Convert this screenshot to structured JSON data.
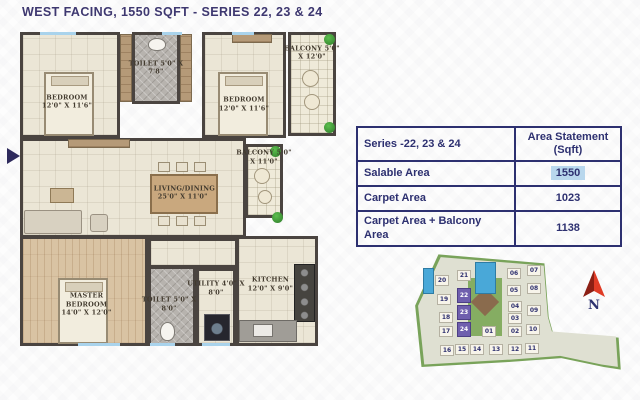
{
  "title": "WEST FACING, 1550 SQFT - SERIES 22, 23 & 24",
  "colors": {
    "accent_navy": "#2d3070",
    "title_navy": "#3e3870",
    "value_highlight_blue": "#b8d7ed",
    "site_block_highlight_purple": "#6f5fae",
    "compass_red": "#e03c26",
    "wall_dark": "#4a4440"
  },
  "floor_plan": {
    "rooms": [
      {
        "id": "bedroom-1",
        "name": "BEDROOM",
        "dims": "12'0\" X 11'6\"",
        "floor": "cream",
        "x": 0,
        "y": 0,
        "w": 100,
        "h": 106,
        "lx": 47,
        "ly": 66
      },
      {
        "id": "toilet-1",
        "name": "TOILET",
        "dims": "5'0\" X 7'8\"",
        "floor": "tile",
        "x": 112,
        "y": 0,
        "w": 48,
        "h": 72,
        "lx": 50,
        "ly": 50
      },
      {
        "id": "bedroom-2",
        "name": "BEDROOM",
        "dims": "12'0\" X 11'6\"",
        "floor": "cream",
        "x": 182,
        "y": 0,
        "w": 84,
        "h": 106,
        "lx": 50,
        "ly": 68
      },
      {
        "id": "balcony-1",
        "name": "BALCONY",
        "dims": "5'0\" X 12'0\"",
        "floor": "grid",
        "x": 268,
        "y": 0,
        "w": 48,
        "h": 104,
        "lx": 50,
        "ly": 20
      },
      {
        "id": "living-dining",
        "name": "LIVING/DINING",
        "dims": "25'0\" X 11'0\"",
        "floor": "cream",
        "x": 0,
        "y": 106,
        "w": 226,
        "h": 100,
        "lx": 72,
        "ly": 55
      },
      {
        "id": "balcony-2",
        "name": "BALCONY",
        "dims": "5'0\" X 11'0\"",
        "floor": "grid",
        "x": 225,
        "y": 112,
        "w": 38,
        "h": 74,
        "lx": 50,
        "ly": 18
      },
      {
        "id": "hallway",
        "name": "",
        "dims": "",
        "floor": "cream",
        "x": 128,
        "y": 206,
        "w": 90,
        "h": 30,
        "lx": 50,
        "ly": 50
      },
      {
        "id": "master-bedroom",
        "name": "MASTER BEDROOM",
        "dims": "14'0\" X 12'0\"",
        "floor": "wood",
        "x": 0,
        "y": 204,
        "w": 128,
        "h": 110,
        "lx": 52,
        "ly": 62
      },
      {
        "id": "toilet-2",
        "name": "TOILET",
        "dims": "5'0\" X 8'0\"",
        "floor": "tile",
        "x": 128,
        "y": 234,
        "w": 48,
        "h": 80,
        "lx": 44,
        "ly": 48
      },
      {
        "id": "utility",
        "name": "UTILITY",
        "dims": "4'0\" X 8'0\"",
        "floor": "cream",
        "x": 176,
        "y": 236,
        "w": 40,
        "h": 78,
        "lx": 50,
        "ly": 26
      },
      {
        "id": "kitchen",
        "name": "KITCHEN",
        "dims": "12'0\" X 9'0\"",
        "floor": "cream",
        "x": 216,
        "y": 204,
        "w": 82,
        "h": 110,
        "lx": 42,
        "ly": 44
      }
    ],
    "furniture": [
      {
        "type": "bed",
        "x": 24,
        "y": 40,
        "w": 50,
        "h": 64
      },
      {
        "type": "bed",
        "x": 198,
        "y": 40,
        "w": 50,
        "h": 64
      },
      {
        "type": "bed-master",
        "x": 38,
        "y": 246,
        "w": 50,
        "h": 66
      },
      {
        "type": "wardrobe",
        "x": 100,
        "y": 2,
        "w": 12,
        "h": 68
      },
      {
        "type": "wardrobe",
        "x": 160,
        "y": 2,
        "w": 12,
        "h": 68
      },
      {
        "type": "wardrobe",
        "x": 212,
        "y": 2,
        "w": 40,
        "h": 9
      },
      {
        "type": "wardrobe",
        "x": 48,
        "y": 107,
        "w": 62,
        "h": 9
      },
      {
        "type": "dining-table",
        "x": 130,
        "y": 142,
        "w": 68,
        "h": 40
      },
      {
        "type": "chair",
        "x": 138,
        "y": 130,
        "w": 12,
        "h": 10
      },
      {
        "type": "chair",
        "x": 156,
        "y": 130,
        "w": 12,
        "h": 10
      },
      {
        "type": "chair",
        "x": 174,
        "y": 130,
        "w": 12,
        "h": 10
      },
      {
        "type": "chair",
        "x": 138,
        "y": 184,
        "w": 12,
        "h": 10
      },
      {
        "type": "chair",
        "x": 156,
        "y": 184,
        "w": 12,
        "h": 10
      },
      {
        "type": "chair",
        "x": 174,
        "y": 184,
        "w": 12,
        "h": 10
      },
      {
        "type": "sofa",
        "x": 4,
        "y": 178,
        "w": 58,
        "h": 24
      },
      {
        "type": "armchair",
        "x": 70,
        "y": 182,
        "w": 18,
        "h": 18
      },
      {
        "type": "coffee-table",
        "x": 30,
        "y": 156,
        "w": 24,
        "h": 15
      },
      {
        "type": "wc",
        "x": 128,
        "y": 6,
        "w": 18,
        "h": 13
      },
      {
        "type": "wc",
        "x": 140,
        "y": 290,
        "w": 15,
        "h": 19
      },
      {
        "type": "washer",
        "x": 184,
        "y": 282,
        "w": 26,
        "h": 27
      },
      {
        "type": "stove",
        "x": 274,
        "y": 232,
        "w": 21,
        "h": 58
      },
      {
        "type": "counter",
        "x": 219,
        "y": 288,
        "w": 58,
        "h": 22
      },
      {
        "type": "sink",
        "x": 233,
        "y": 292,
        "w": 20,
        "h": 13
      },
      {
        "type": "chair-round",
        "x": 282,
        "y": 38,
        "w": 17,
        "h": 17
      },
      {
        "type": "chair-round",
        "x": 284,
        "y": 62,
        "w": 16,
        "h": 16
      },
      {
        "type": "chair-round",
        "x": 234,
        "y": 136,
        "w": 16,
        "h": 16
      },
      {
        "type": "chair-round",
        "x": 238,
        "y": 158,
        "w": 14,
        "h": 14
      },
      {
        "type": "plant",
        "x": 304,
        "y": 2,
        "w": 11,
        "h": 11
      },
      {
        "type": "plant",
        "x": 304,
        "y": 90,
        "w": 11,
        "h": 11
      },
      {
        "type": "plant",
        "x": 250,
        "y": 114,
        "w": 11,
        "h": 11
      },
      {
        "type": "plant",
        "x": 252,
        "y": 180,
        "w": 11,
        "h": 11
      },
      {
        "type": "window",
        "x": 20,
        "y": 0,
        "w": 36,
        "h": 3
      },
      {
        "type": "window",
        "x": 142,
        "y": 0,
        "w": 20,
        "h": 3
      },
      {
        "type": "window",
        "x": 212,
        "y": 0,
        "w": 22,
        "h": 3
      },
      {
        "type": "window",
        "x": 58,
        "y": 311,
        "w": 42,
        "h": 3
      },
      {
        "type": "window",
        "x": 130,
        "y": 311,
        "w": 25,
        "h": 3
      },
      {
        "type": "window",
        "x": 182,
        "y": 311,
        "w": 28,
        "h": 3
      }
    ]
  },
  "area_table": {
    "header": [
      "Series -22, 23 & 24",
      "Area Statement (Sqft)"
    ],
    "rows": [
      {
        "label": "Salable Area",
        "value": "1550",
        "highlight": true
      },
      {
        "label": "Carpet Area",
        "value": "1023",
        "highlight": false
      },
      {
        "label": "Carpet Area + Balcony Area",
        "value": "1138",
        "highlight": false
      }
    ]
  },
  "site_plan": {
    "compass": "N",
    "highlighted_blocks": [
      "22",
      "23",
      "24"
    ],
    "blocks": [
      {
        "id": "20",
        "x": 22,
        "y": 27
      },
      {
        "id": "21",
        "x": 44,
        "y": 22
      },
      {
        "id": "06",
        "x": 94,
        "y": 20
      },
      {
        "id": "07",
        "x": 114,
        "y": 17
      },
      {
        "id": "19",
        "x": 24,
        "y": 46
      },
      {
        "id": "22",
        "x": 44,
        "y": 40,
        "hl": true
      },
      {
        "id": "05",
        "x": 94,
        "y": 37
      },
      {
        "id": "08",
        "x": 114,
        "y": 35
      },
      {
        "id": "23",
        "x": 44,
        "y": 57,
        "hl": true
      },
      {
        "id": "18",
        "x": 26,
        "y": 64
      },
      {
        "id": "04",
        "x": 95,
        "y": 53
      },
      {
        "id": "09",
        "x": 114,
        "y": 57
      },
      {
        "id": "03",
        "x": 95,
        "y": 65
      },
      {
        "id": "17",
        "x": 26,
        "y": 78
      },
      {
        "id": "24",
        "x": 44,
        "y": 74,
        "hl": true
      },
      {
        "id": "01",
        "x": 69,
        "y": 78
      },
      {
        "id": "02",
        "x": 95,
        "y": 78
      },
      {
        "id": "10",
        "x": 113,
        "y": 76
      },
      {
        "id": "16",
        "x": 27,
        "y": 97
      },
      {
        "id": "15",
        "x": 42,
        "y": 96
      },
      {
        "id": "14",
        "x": 57,
        "y": 96
      },
      {
        "id": "13",
        "x": 76,
        "y": 96
      },
      {
        "id": "12",
        "x": 95,
        "y": 96
      },
      {
        "id": "11",
        "x": 112,
        "y": 95
      }
    ]
  }
}
